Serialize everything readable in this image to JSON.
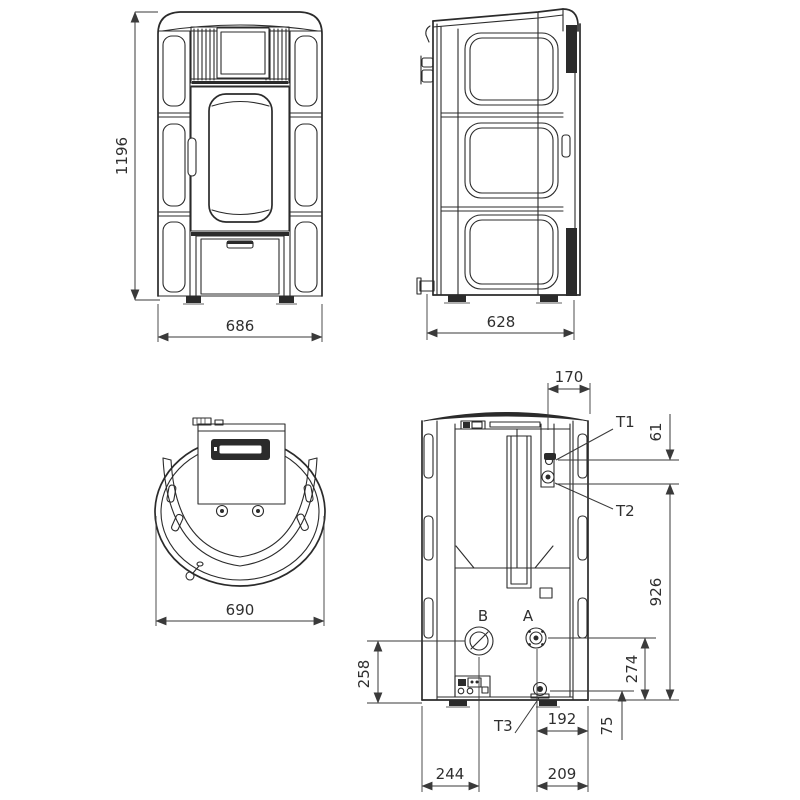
{
  "drawing": {
    "subject": "pellet-stove-dimensional-drawing",
    "background_color": "#ffffff",
    "line_color": "#2b2b2b",
    "text_color": "#2f2f2f",
    "front": {
      "height": "1196",
      "width": "686"
    },
    "side": {
      "depth": "628"
    },
    "top": {
      "width": "690"
    },
    "rear": {
      "flue_offset": "170",
      "sensor_gap": "61",
      "return_height": "926",
      "b_height": "258",
      "a_height": "274",
      "t3_height": "75",
      "t3_offset": "192",
      "b_offset": "244",
      "a_offset": "209",
      "t1_label": "T1",
      "t2_label": "T2",
      "t3_label": "T3",
      "a_label": "A",
      "b_label": "B"
    }
  }
}
